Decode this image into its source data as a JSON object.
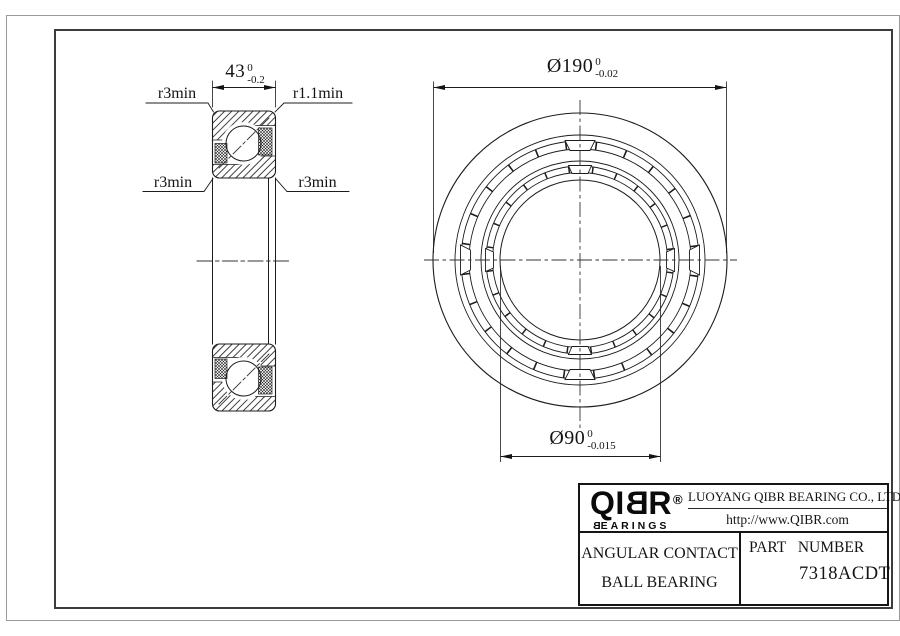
{
  "section_view": {
    "width_dim": {
      "value": "43",
      "tol_upper": "0",
      "tol_lower": "-0.2"
    },
    "callout_top_left": "r3min",
    "callout_top_right": "r1.1min",
    "callout_bottom_left": "r3min",
    "callout_bottom_right": "r3min"
  },
  "front_view": {
    "outer_diameter_dim": {
      "value": "Ø190",
      "tol_upper": "0",
      "tol_lower": "-0.02"
    },
    "bore_diameter_dim": {
      "value": "Ø90",
      "tol_upper": "0",
      "tol_lower": "-0.015"
    }
  },
  "title_block": {
    "logo": {
      "part_a": "QI",
      "part_b": "B",
      "part_c": "R",
      "reg": "®",
      "sub_first": "B",
      "sub_rest": "EARINGS"
    },
    "company_name": "LUOYANG QIBR BEARING CO., LTD",
    "website": "http://www.QIBR.com",
    "product_line1": "ANGULAR CONTACT",
    "product_line2": "BALL BEARING",
    "part_number_label": "PART NUMBER",
    "part_number": "7318ACDT"
  }
}
